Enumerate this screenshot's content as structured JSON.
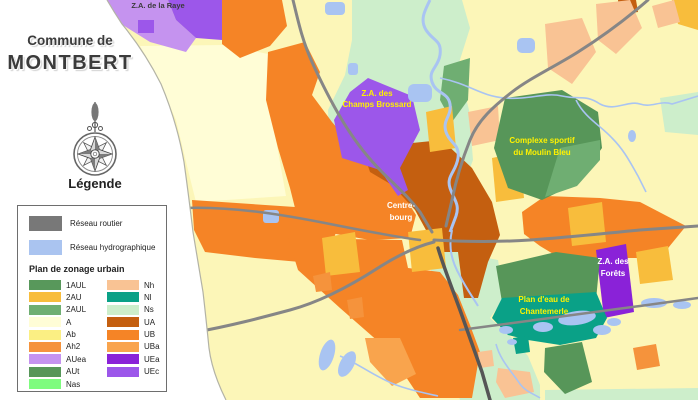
{
  "colors": {
    "1AUL": "#58985b",
    "2AU": "#f8bd3c",
    "2AUL": "#6fae72",
    "A": "#fffdd6",
    "Ab": "#fbef83",
    "Ah2": "#f5933c",
    "AUea": "#c593ef",
    "AUt": "#579659",
    "Nas": "#7efc7e",
    "Nh": "#f9c394",
    "Nl": "#0aa187",
    "Ns": "#cdeecb",
    "UA": "#c45f10",
    "UB": "#f58426",
    "UBa": "#f9a44d",
    "UEa": "#8a22d8",
    "UEc": "#9c57ea",
    "field": "#fcf6b8",
    "routier": "#787878",
    "hydro": "#aac4f0",
    "road": "#868686",
    "road_dark": "#565656",
    "water": "#a9c4f2",
    "boundary": "#b3b3a6",
    "label_yellow": "#fff200",
    "label_white": "#ffffff",
    "label_dark": "#3a3a3a"
  },
  "panel": {
    "title_line1": "Commune de",
    "title_line2": "MONTBERT",
    "legend_title": "Légende",
    "legend": {
      "routier_label": "Réseau routier",
      "hydro_label": "Réseau hydrographique",
      "zonage_title": "Plan de zonage urbain",
      "zones_left": [
        "1AUL",
        "2AU",
        "2AUL",
        "A",
        "Ab",
        "Ah2",
        "AUea",
        "AUt",
        "Nas"
      ],
      "zones_right": [
        "Nh",
        "Nl",
        "Ns",
        "UA",
        "UB",
        "UBa",
        "UEa",
        "UEc"
      ]
    }
  },
  "map": {
    "labels": {
      "za_raye": "Z.A. de la Raye",
      "za_brossard_line1": "Z.A. des",
      "za_brossard_line2": "Champs Brossard",
      "complexe_line1": "Complexe sportif",
      "complexe_line2": "du Moulin Bleu",
      "bourg_line1": "Centre-",
      "bourg_line2": "bourg",
      "za_forets_line1": "Z.A. des",
      "za_forets_line2": "Forêts",
      "plan_eau_line1": "Plan d'eau de",
      "plan_eau_line2": "Chantemerle"
    }
  }
}
